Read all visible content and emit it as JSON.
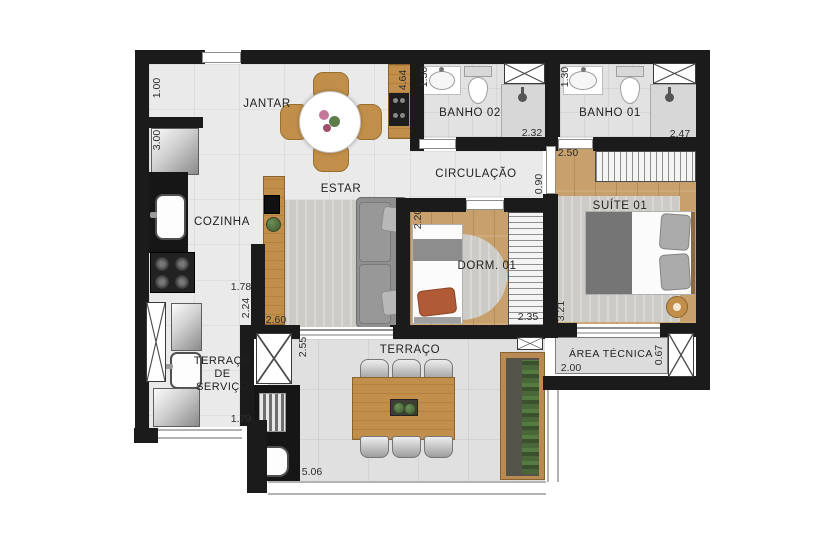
{
  "floorplan": {
    "unit": "m",
    "rooms": {
      "jantar": {
        "label": "JANTAR"
      },
      "cozinha": {
        "label": "COZINHA"
      },
      "estar": {
        "label": "ESTAR"
      },
      "circulacao": {
        "label": "CIRCULAÇÃO"
      },
      "banho02": {
        "label": "BANHO 02"
      },
      "banho01": {
        "label": "BANHO 01"
      },
      "suite01": {
        "label": "SUÍTE 01"
      },
      "dorm01": {
        "label": "DORM. 01"
      },
      "terraco": {
        "label": "TERRAÇO"
      },
      "terraco_servico": {
        "label_lines": [
          "TERRAÇO",
          "DE",
          "SERVIÇO"
        ]
      },
      "area_tecnica": {
        "label": "ÁREA TÉCNICA"
      }
    },
    "dimensions": {
      "entry_recess": "1.00",
      "kitchen_wall": "3.00",
      "social_length": "4.64",
      "banho02_sink_wall": "1.30",
      "banho02_width": "2.32",
      "banho01_sink_wall": "1.30",
      "banho01_width": "2.47",
      "suite_closet": "2.50",
      "circulation_width": "0.90",
      "dorm_depth": "2.20",
      "dorm_width": "2.35",
      "suite_depth": "3.21",
      "kitchen_opening": "1.78",
      "kitchen_counter": "2.24",
      "estar_width": "2.60",
      "terraco_depth": "2.55",
      "servico_opening": "1.79",
      "terraco_width": "5.06",
      "area_tecnica_width": "2.00",
      "area_tecnica_depth": "0.67"
    },
    "colors": {
      "wall": "#1b1b1b",
      "floor_tile": "#eaeaea",
      "bath_floor": "#e2e2e2",
      "wood_floor": "#c8a06c",
      "terrace_floor": "#e0e0e0",
      "furniture_wood": "#c28f4a",
      "sofa_gray": "#8f8f8f",
      "rug_gray": "#cdcbc6",
      "counter_black": "#161616",
      "plant_green": "#4d683c",
      "pillow_orange": "#b05a36",
      "dim_text": "#2e2e2e"
    },
    "fixtures": [
      "entry-door",
      "fridge-icon",
      "kitchen-sink-icon",
      "stove-icon",
      "tv-icon",
      "sofa",
      "dining-table",
      "terrace-table",
      "double-bed",
      "single-bed",
      "wardrobe",
      "toilet-icon",
      "bathroom-sink-icon",
      "shower-icon",
      "laundry-tank-icon",
      "washer-icon",
      "water-heater-icon",
      "planter",
      "side-table"
    ]
  }
}
